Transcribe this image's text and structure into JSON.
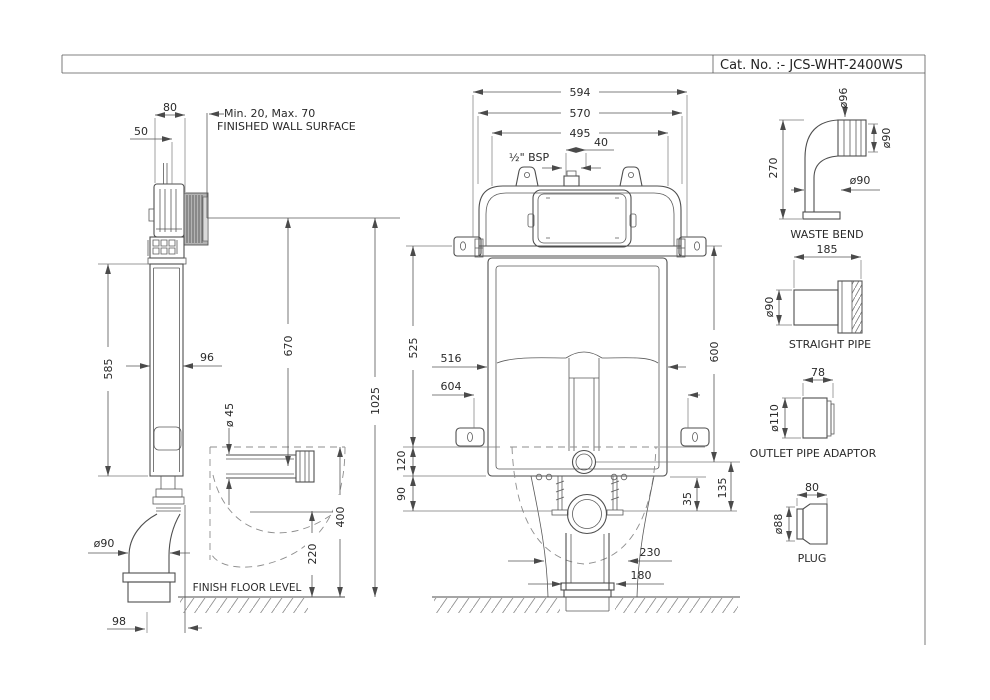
{
  "title_block": {
    "cat_no": "Cat. No. :- JCS-WHT-2400WS"
  },
  "side_view": {
    "dims": {
      "d80": "80",
      "d50": "50",
      "wall_range": "Min. 20, Max. 70",
      "wall_surface": "FINISHED WALL SURFACE",
      "d585": "585",
      "d96": "96",
      "d670": "670",
      "d1025": "1025",
      "d45": "ø 45",
      "d90": "ø90",
      "d400": "400",
      "d220": "220",
      "d98": "98",
      "floor_level": "FINISH FLOOR LEVEL"
    }
  },
  "front_view": {
    "dims": {
      "d594": "594",
      "d570": "570",
      "d495": "495",
      "d40": "40",
      "bsp": "½\" BSP",
      "d525": "525",
      "d516": "516",
      "d604": "604",
      "d120": "120",
      "d90": "90",
      "d600": "600",
      "d35": "35",
      "d135": "135",
      "d230": "230",
      "d180": "180"
    }
  },
  "accessories": {
    "waste_bend": {
      "label": "WASTE BEND",
      "d96": "ø96",
      "d90_collar": "ø90",
      "d270": "270",
      "d90_pipe": "ø90"
    },
    "straight_pipe": {
      "label": "STRAIGHT PIPE",
      "d185": "185",
      "d90": "ø90"
    },
    "outlet_pipe_adaptor": {
      "label": "OUTLET PIPE ADAPTOR",
      "d78": "78",
      "d110": "ø110"
    },
    "plug": {
      "label": "PLUG",
      "d80": "80",
      "d88": "ø88"
    }
  }
}
